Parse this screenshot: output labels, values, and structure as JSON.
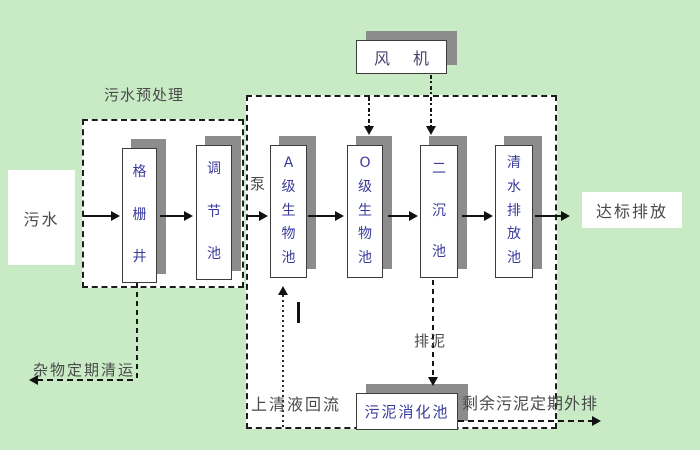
{
  "colors": {
    "background": "#c8ebc6",
    "panel_fill": "#ffffff",
    "shadow": "#8c8c8c",
    "line": "#161616",
    "tank_text": "#3b3b9e",
    "label_text": "#4a4a4a"
  },
  "source": {
    "label": "污水"
  },
  "outlet": {
    "label": "达标排放"
  },
  "fan": {
    "label": "风 机"
  },
  "pretreatment": {
    "label": "污水预处理"
  },
  "pump": {
    "label": "泵"
  },
  "tanks": [
    {
      "name": "grid-well",
      "chars": [
        "格",
        "栅",
        "井"
      ]
    },
    {
      "name": "regulating-tank",
      "chars": [
        "调",
        "节",
        "池"
      ]
    },
    {
      "name": "a-level-bio-tank",
      "chars": [
        "A",
        "级",
        "生",
        "物",
        "池"
      ]
    },
    {
      "name": "o-level-bio-tank",
      "chars": [
        "O",
        "级",
        "生",
        "物",
        "池"
      ]
    },
    {
      "name": "secondary-sedimentation-tank",
      "chars": [
        "二",
        "沉",
        "池"
      ]
    },
    {
      "name": "clear-water-discharge-tank",
      "chars": [
        "清",
        "水",
        "排",
        "放",
        "池"
      ]
    }
  ],
  "digestion": {
    "label": "污泥消化池"
  },
  "annotations": {
    "debris_removal": "杂物定期清运",
    "supernatant_return": "上清液回流",
    "sludge_discharge": "排泥",
    "excess_sludge": "剩余污泥定期外排"
  }
}
